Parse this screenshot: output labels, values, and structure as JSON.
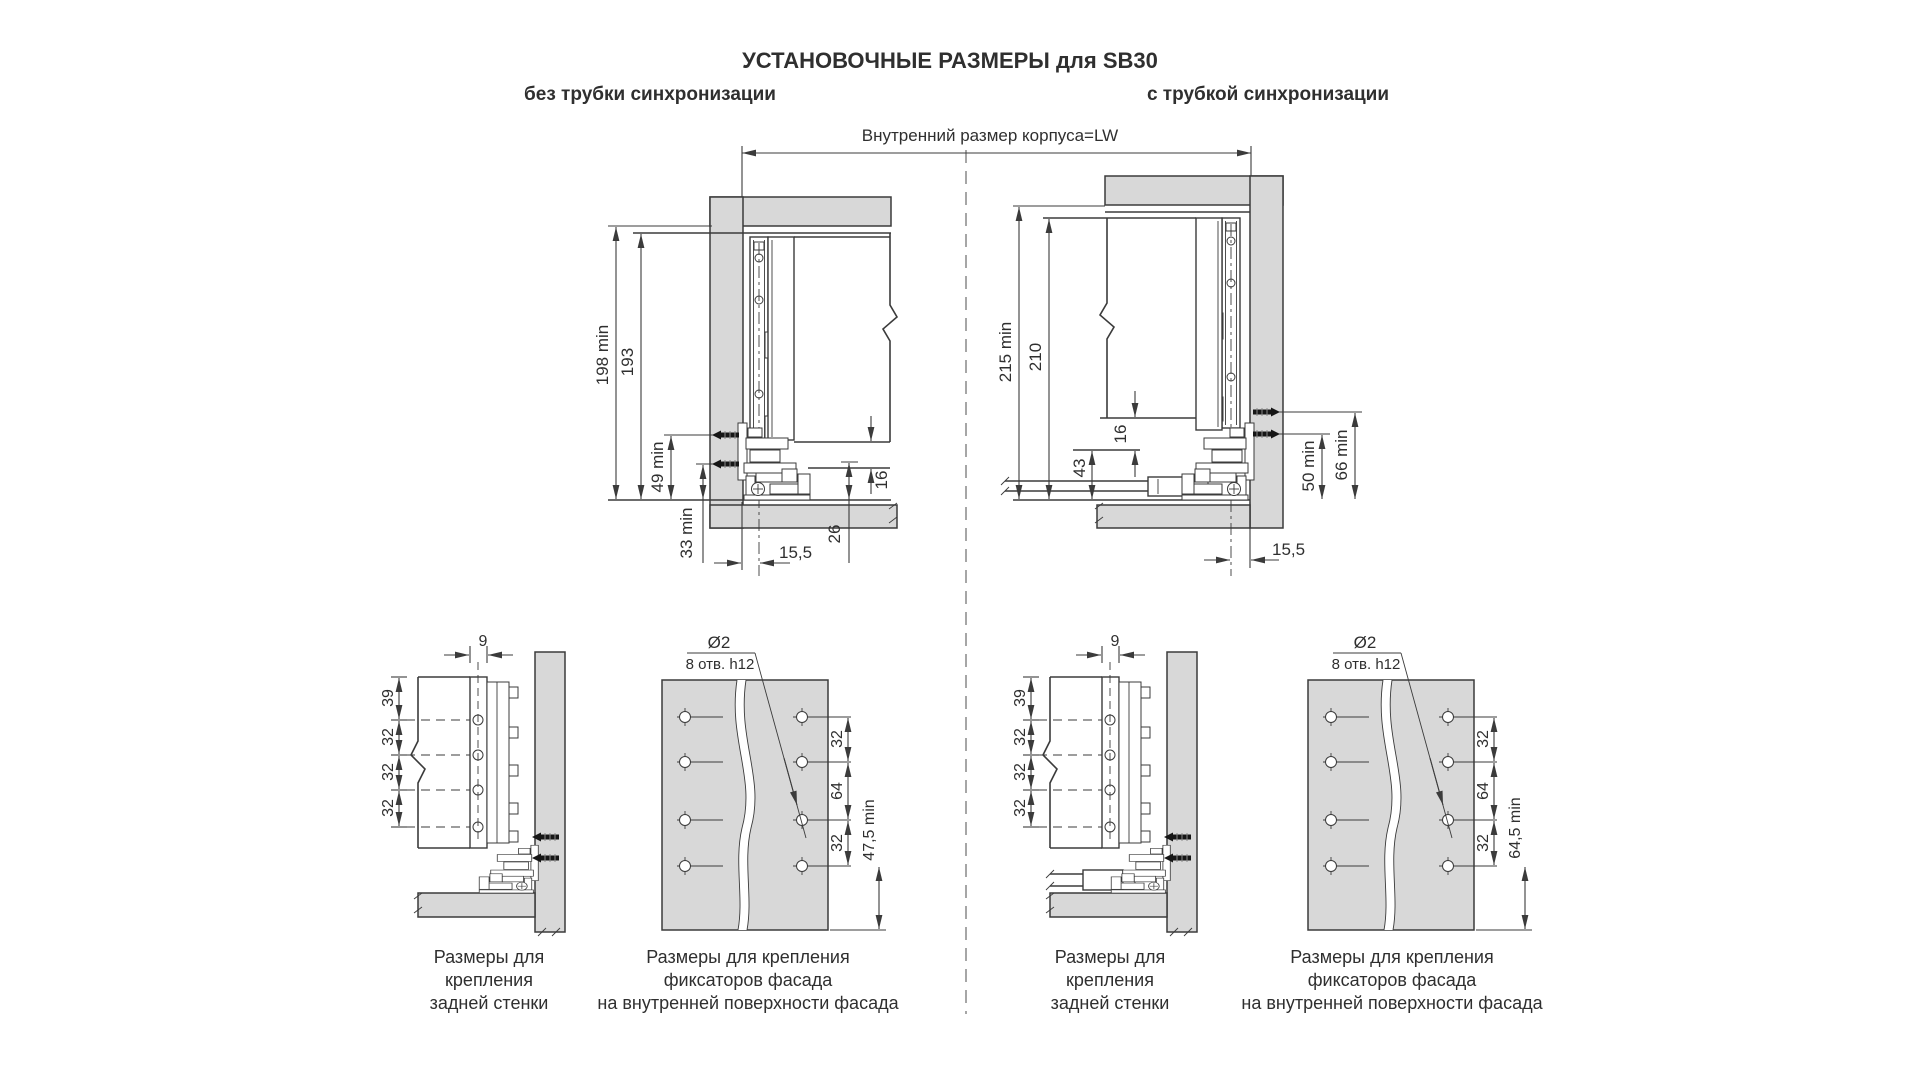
{
  "colors": {
    "line": "#3b3b3b",
    "panel_gray": "#d8d8d8",
    "screw_black": "#161616",
    "background": "#ffffff"
  },
  "header": {
    "title": "УСТАНОВОЧНЫЕ РАЗМЕРЫ для SB30",
    "left_heading": "без трубки синхронизации",
    "right_heading": "с трубкой синхронизации",
    "width_label": "Внутренний размер корпуса=LW"
  },
  "no_tube": {
    "height_min": "198 min",
    "height": "193",
    "screw_top": "49 min",
    "screw_bottom": "33 min",
    "front_offset": "15,5",
    "bottom_gap": "26",
    "bottom_thickness": "16"
  },
  "with_tube": {
    "height_min": "215 min",
    "height": "210",
    "bottom_thickness": "16",
    "tube_height": "43",
    "screw_bottom": "50 min",
    "screw_top": "66 min",
    "front_offset": "15,5"
  },
  "rear_left": {
    "offset": "9",
    "top": "39",
    "step1": "32",
    "step2": "32",
    "step3": "32",
    "caption1": "Размеры для",
    "caption2": "крепления",
    "caption3": "задней стенки"
  },
  "rear_right": {
    "offset": "9",
    "top": "39",
    "step1": "32",
    "step2": "32",
    "step3": "32",
    "caption1": "Размеры для",
    "caption2": "крепления",
    "caption3": "задней стенки"
  },
  "facade_left": {
    "diameter": "Ø2",
    "holes_note": "8 отв. h12",
    "step1": "32",
    "step2": "64",
    "step3": "32",
    "edge_min": "47,5 min",
    "caption1": "Размеры для крепления",
    "caption2": "фиксаторов фасада",
    "caption3": "на внутренней поверхности фасада"
  },
  "facade_right": {
    "diameter": "Ø2",
    "holes_note": "8 отв. h12",
    "step1": "32",
    "step2": "64",
    "step3": "32",
    "edge_min": "64,5 min",
    "caption1": "Размеры для крепления",
    "caption2": "фиксаторов фасада",
    "caption3": "на внутренней поверхности фасада"
  }
}
